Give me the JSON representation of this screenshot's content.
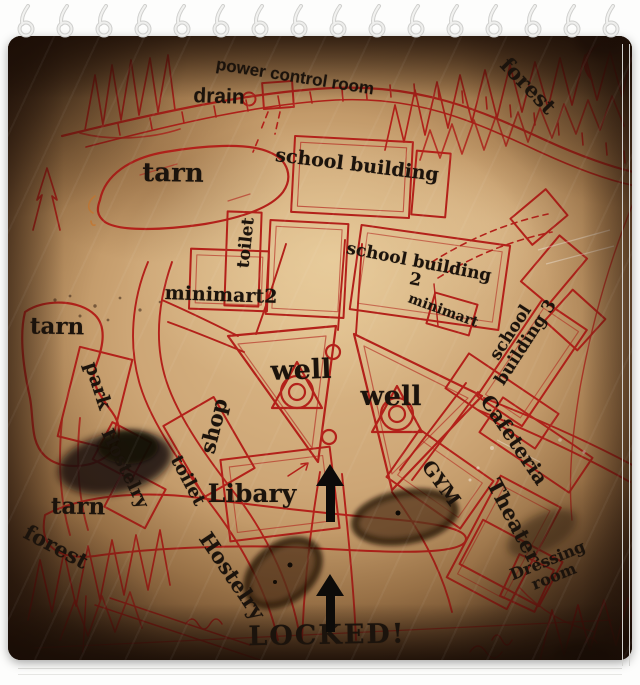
{
  "map": {
    "colors": {
      "ink": "#b3211a",
      "label": "#1b130c",
      "paper": "#cda676",
      "paper_edge": "#4e3118",
      "page_bg": "#ffffff"
    },
    "labels": [
      {
        "id": "power-control-room",
        "text": "power control room",
        "x": 295,
        "y": 77,
        "rot": 9,
        "size": 17,
        "font": "sans"
      },
      {
        "id": "drain",
        "text": "drain",
        "x": 219,
        "y": 97,
        "rot": 2,
        "size": 21,
        "font": "sans"
      },
      {
        "id": "forest-top-right",
        "text": "forest",
        "x": 528,
        "y": 86,
        "rot": 46,
        "size": 21,
        "font": "serif"
      },
      {
        "id": "tarn-upper",
        "text": "tarn",
        "x": 173,
        "y": 174,
        "rot": 1,
        "size": 26,
        "font": "serif"
      },
      {
        "id": "school-building",
        "text": "school building",
        "x": 357,
        "y": 166,
        "rot": 7,
        "size": 19,
        "font": "serif"
      },
      {
        "id": "toilet-upper",
        "text": "toilet",
        "x": 247,
        "y": 243,
        "rot": -84,
        "size": 17,
        "font": "serif"
      },
      {
        "id": "minimart2",
        "text": "minimart2",
        "x": 221,
        "y": 296,
        "rot": 2,
        "size": 19,
        "font": "serif"
      },
      {
        "id": "school-building-2",
        "text": "school building\n2",
        "x": 417,
        "y": 272,
        "rot": 11,
        "size": 17,
        "font": "serif"
      },
      {
        "id": "minimart",
        "text": "minimart",
        "x": 443,
        "y": 311,
        "rot": 20,
        "size": 14,
        "font": "serif"
      },
      {
        "id": "school-building-3",
        "text": "school building 3",
        "x": 519,
        "y": 338,
        "rot": -57,
        "size": 17,
        "font": "serif"
      },
      {
        "id": "tarn-left",
        "text": "tarn",
        "x": 57,
        "y": 327,
        "rot": 1,
        "size": 23,
        "font": "serif"
      },
      {
        "id": "park",
        "text": "park",
        "x": 97,
        "y": 386,
        "rot": 72,
        "size": 19,
        "font": "serif"
      },
      {
        "id": "well-left",
        "text": "well",
        "x": 301,
        "y": 371,
        "rot": -2,
        "size": 27,
        "font": "serif"
      },
      {
        "id": "well-right",
        "text": "well",
        "x": 391,
        "y": 397,
        "rot": 0,
        "size": 27,
        "font": "serif"
      },
      {
        "id": "shop",
        "text": "shop",
        "x": 214,
        "y": 426,
        "rot": -76,
        "size": 21,
        "font": "serif"
      },
      {
        "id": "cafeteria",
        "text": "Cafeteria",
        "x": 514,
        "y": 440,
        "rot": 56,
        "size": 20,
        "font": "serif"
      },
      {
        "id": "hostelry-upper",
        "text": "Hostelry",
        "x": 124,
        "y": 469,
        "rot": 64,
        "size": 18,
        "font": "serif"
      },
      {
        "id": "toilet-lower",
        "text": "toilet",
        "x": 187,
        "y": 481,
        "rot": 62,
        "size": 18,
        "font": "serif"
      },
      {
        "id": "libary",
        "text": "Libary",
        "x": 252,
        "y": 494,
        "rot": 0,
        "size": 25,
        "font": "serif"
      },
      {
        "id": "gym",
        "text": "GYM",
        "x": 440,
        "y": 484,
        "rot": 54,
        "size": 19,
        "font": "serif"
      },
      {
        "id": "theater",
        "text": "Theater",
        "x": 514,
        "y": 521,
        "rot": 62,
        "size": 21,
        "font": "serif"
      },
      {
        "id": "tarn-bottom",
        "text": "tarn",
        "x": 78,
        "y": 507,
        "rot": 1,
        "size": 23,
        "font": "serif"
      },
      {
        "id": "forest-bottom",
        "text": "forest",
        "x": 56,
        "y": 547,
        "rot": 28,
        "size": 21,
        "font": "serif"
      },
      {
        "id": "hostelry-bottom",
        "text": "Hostelry",
        "x": 232,
        "y": 576,
        "rot": 56,
        "size": 21,
        "font": "serif"
      },
      {
        "id": "dressing-room",
        "text": "Dressing room",
        "x": 551,
        "y": 569,
        "rot": -22,
        "size": 16,
        "font": "serif"
      },
      {
        "id": "locked",
        "text": "LOCKED!",
        "x": 327,
        "y": 636,
        "rot": -1,
        "size": 27,
        "font": "serif",
        "ls": 2
      }
    ],
    "arrows": [
      {
        "id": "path-arrow-upper",
        "x": 330,
        "y": 464
      },
      {
        "id": "path-arrow-lower",
        "x": 330,
        "y": 574
      }
    ]
  },
  "binder": {
    "ring_count": 16
  }
}
